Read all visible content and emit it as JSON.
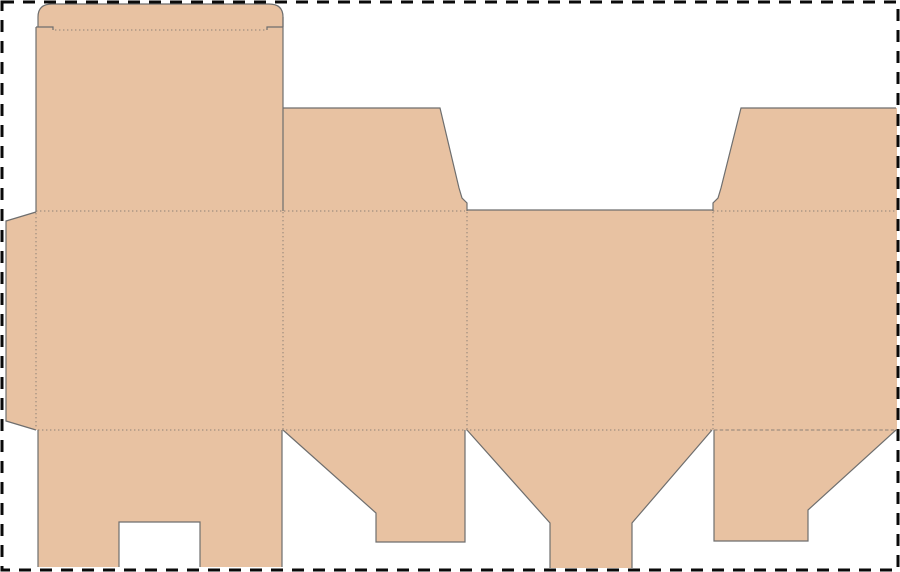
{
  "canvas": {
    "width": 900,
    "height": 572,
    "background": "#ffffff"
  },
  "artboard_border": {
    "x": 2,
    "y": 2,
    "width": 896,
    "height": 568,
    "color": "#0a0a0a",
    "thickness": 3,
    "dash": "12 9"
  },
  "style": {
    "board_fill": "#e8c2a2",
    "cut_color": "#6e6e6e",
    "cut_width": 1.2,
    "crease_color": "#8d8075",
    "crease_width": 1,
    "crease_dot_dash": "1.4 2.6",
    "crease_dash_dash": "3.5 2.2"
  },
  "pieces": [
    {
      "name": "tuck-flap",
      "d": "M38,30 V17 Q38,4 52,4 H269 Q283,4 283,17 V30 Z"
    },
    {
      "name": "main-panel",
      "d": "M36,27 H283 V430 H36 Z"
    },
    {
      "name": "glue-flap",
      "d": "M36,212 L6,221 V421 L36,430 Z"
    },
    {
      "name": "dust-flap-left",
      "d": "M283,108 H440 L459,188 L462,198 L467,203 V211 H283 Z"
    },
    {
      "name": "side-panel-left",
      "d": "M283,211 H467 V430 H283 Z"
    },
    {
      "name": "back-panel",
      "d": "M467,210 H713 V430 H467 Z"
    },
    {
      "name": "side-panel-right",
      "d": "M713,211 H897 V430 H713 Z"
    },
    {
      "name": "dust-flap-right",
      "d": "M741,108 H897 V211 H713 V203 L718,198 L721,188 Z"
    },
    {
      "name": "bottom-flap-main",
      "d": "M38,430 H282 V567 H200 V522 H119 V567 H38 Z"
    },
    {
      "name": "bottom-flap-left",
      "d": "M283,430 H465 V542 H376 V513 Z"
    },
    {
      "name": "bottom-flap-back",
      "d": "M467,430 H712 L632,523 V568 H550 V523 Z"
    },
    {
      "name": "bottom-flap-right",
      "d": "M714,430 H896 L808,510 V541 H714 Z"
    }
  ],
  "cut_lines": [
    {
      "name": "tuck-flap-outline-cut",
      "d": "M38,27 V17 Q38,4 52,4 H269 Q283,4 283,17 V27"
    },
    {
      "name": "tuck-shoulder-left-cut",
      "d": "M36,27 H53 V30"
    },
    {
      "name": "tuck-shoulder-right-cut",
      "d": "M283,27 H267 V30"
    },
    {
      "name": "main-panel-left-cut",
      "d": "M36,27 V212"
    },
    {
      "name": "main-panel-right-cut",
      "d": "M283,17 V211"
    },
    {
      "name": "glue-flap-cut",
      "d": "M36,212 L6,221 V421 L36,430"
    },
    {
      "name": "dust-flap-left-cut",
      "d": "M283,108 H440 L459,188 L462,198 L467,203 V211"
    },
    {
      "name": "back-panel-top-cut",
      "d": "M467,210 H713"
    },
    {
      "name": "dust-flap-right-cut",
      "d": "M896,108 H741 L721,188 L718,198 L713,203 V211"
    },
    {
      "name": "bottom-flap-main-cut",
      "d": "M38,430 V567 M282,430 V567 M119,567 V522 H200 V567"
    },
    {
      "name": "bottom-flap-left-cut",
      "d": "M283,430 L376,513 V542 H465 V430"
    },
    {
      "name": "bottom-flap-back-cut",
      "d": "M467,430 L550,523 V568 M712,430 L632,523 V568"
    },
    {
      "name": "bottom-flap-right-cut",
      "d": "M896,430 L808,510 V541 H714 V430"
    }
  ],
  "fold_lines": [
    {
      "name": "tuck-fold",
      "d": "M55,30 H265",
      "style": "dot"
    },
    {
      "name": "top-fold-left",
      "d": "M36,211 H465",
      "style": "dot"
    },
    {
      "name": "top-fold-right",
      "d": "M713,211 H896",
      "style": "dot"
    },
    {
      "name": "glue-fold",
      "d": "M36,213 V429",
      "style": "dot"
    },
    {
      "name": "panel-fold-1",
      "d": "M283,212 V430",
      "style": "dot"
    },
    {
      "name": "panel-fold-2",
      "d": "M467,212 V430",
      "style": "dot"
    },
    {
      "name": "panel-fold-3",
      "d": "M713,212 V430",
      "style": "dot"
    },
    {
      "name": "bottom-fold-main",
      "d": "M38,430 H712",
      "style": "dot"
    },
    {
      "name": "bottom-fold-right",
      "d": "M714,430 H896",
      "style": "dash"
    }
  ]
}
